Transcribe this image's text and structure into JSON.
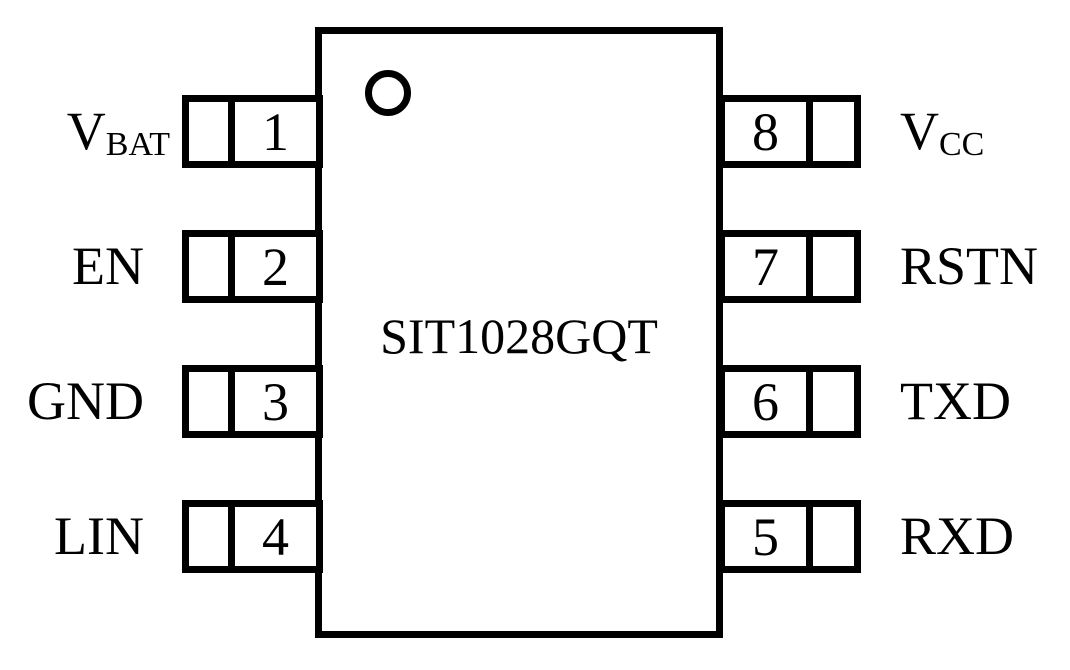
{
  "diagram": {
    "type": "ic-pinout",
    "chip_label": "SIT1028GQT",
    "package_pins": 8,
    "left_pins": [
      {
        "number": "1",
        "name": "V",
        "subscript": "BAT"
      },
      {
        "number": "2",
        "name": "EN",
        "subscript": ""
      },
      {
        "number": "3",
        "name": "GND",
        "subscript": ""
      },
      {
        "number": "4",
        "name": "LIN",
        "subscript": ""
      }
    ],
    "right_pins": [
      {
        "number": "8",
        "name": "V",
        "subscript": "CC"
      },
      {
        "number": "7",
        "name": "RSTN",
        "subscript": ""
      },
      {
        "number": "6",
        "name": "TXD",
        "subscript": ""
      },
      {
        "number": "5",
        "name": "RXD",
        "subscript": ""
      }
    ]
  },
  "colors": {
    "line": "#000000",
    "bg": "#ffffff"
  }
}
